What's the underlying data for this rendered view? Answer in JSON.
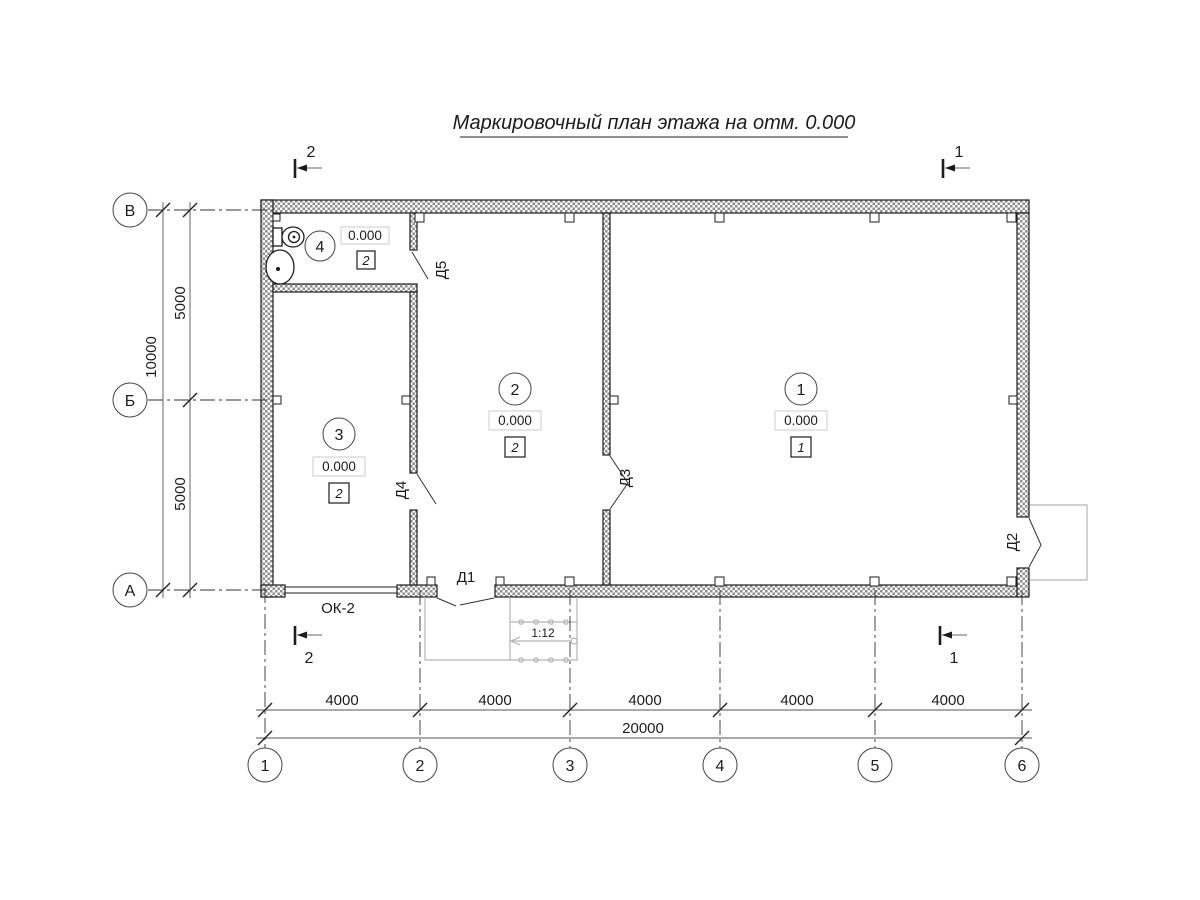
{
  "title": "Маркировочный план этажа на отм. 0.000",
  "row_axes": [
    {
      "label": "В"
    },
    {
      "label": "Б"
    },
    {
      "label": "А"
    }
  ],
  "col_axes": [
    {
      "label": "1"
    },
    {
      "label": "2"
    },
    {
      "label": "3"
    },
    {
      "label": "4"
    },
    {
      "label": "5"
    },
    {
      "label": "6"
    }
  ],
  "dims": {
    "left_total": "10000",
    "left_segments": [
      "5000",
      "5000"
    ],
    "bottom_segments": [
      "4000",
      "4000",
      "4000",
      "4000",
      "4000"
    ],
    "bottom_total": "20000"
  },
  "rooms": [
    {
      "number": "1",
      "elevation": "0.000",
      "finish_type": "1"
    },
    {
      "number": "2",
      "elevation": "0.000",
      "finish_type": "2"
    },
    {
      "number": "3",
      "elevation": "0.000",
      "finish_type": "2"
    },
    {
      "number": "4",
      "elevation": "0.000",
      "finish_type": "2"
    }
  ],
  "doors": [
    {
      "label": "Д1"
    },
    {
      "label": "Д2"
    },
    {
      "label": "Д3"
    },
    {
      "label": "Д4"
    },
    {
      "label": "Д5"
    }
  ],
  "window": {
    "label": "ОК-2"
  },
  "ramp": {
    "slope": "1:12"
  },
  "sections": [
    {
      "label": "1"
    },
    {
      "label": "2"
    }
  ],
  "colors": {
    "line": "#1c1c1c",
    "light": "#b3b3b3",
    "hatch": "#8f8f8f",
    "box_border": "#cccccc"
  }
}
